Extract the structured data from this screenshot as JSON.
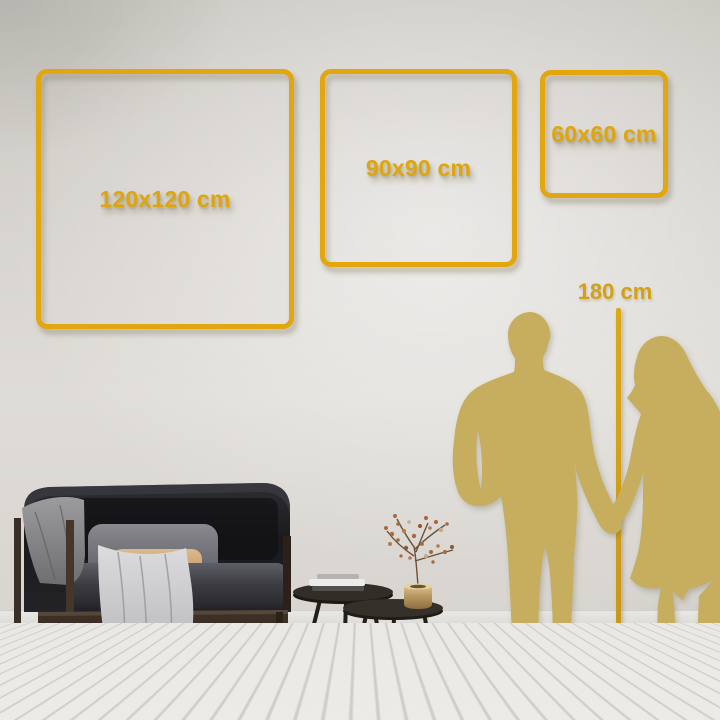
{
  "colors": {
    "frame_gold": "#E2A60E",
    "label_gold": "#DFA50D",
    "ruler_gold": "#D2A117",
    "silhouette_gold": "#C6AE5E",
    "wall": "#D7D4CE",
    "floor": "#EFEDEA"
  },
  "frames": [
    {
      "label": "120x120 cm",
      "width_cm": 120,
      "height_cm": 120
    },
    {
      "label": "90x90 cm",
      "width_cm": 90,
      "height_cm": 90
    },
    {
      "label": "60x60 cm",
      "width_cm": 60,
      "height_cm": 60
    }
  ],
  "ruler": {
    "label": "180 cm",
    "height_cm": 180
  },
  "scene_objects": {
    "silhouettes": "couple-holding-hands",
    "furniture": [
      "dark-velvet-sofa",
      "gray-blanket",
      "gray-pillow",
      "tan-pillow",
      "light-throw",
      "nesting-coffee-tables",
      "book-stack",
      "brass-vase",
      "dried-branch"
    ]
  }
}
